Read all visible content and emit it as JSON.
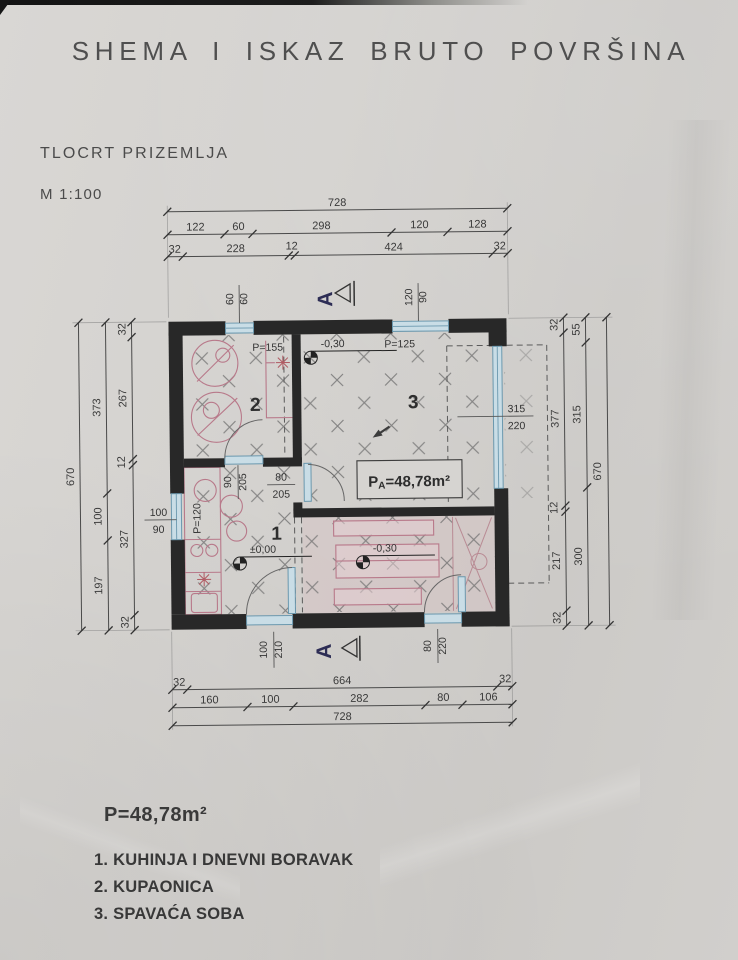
{
  "document": {
    "title": "SHEMA I ISKAZ BRUTO POVRŠINA",
    "drawing_name": "TLOCRT PRIZEMLJA",
    "scale": "M 1:100"
  },
  "summary": {
    "total_area": "P=48,78m²",
    "legend": [
      "1. KUHINJA I DNEVNI BORAVAK",
      "2. KUPAONICA",
      "3. SPAVAĆA SOBA"
    ]
  },
  "plan": {
    "rooms": {
      "kitchen_living": "1",
      "bathroom": "2",
      "bedroom": "3"
    },
    "area_box": {
      "prefix": "P",
      "sub": "A",
      "value": "=48,78m²"
    },
    "levels": {
      "main": "±0,00",
      "bedroom": "-0,30",
      "terrace": "-0,30"
    },
    "parapets": {
      "bathroom_window": "P=155",
      "bedroom_window": "P=125",
      "kitchen_window": "P=120"
    },
    "openings": {
      "bath_window": {
        "w": "60",
        "h": "60"
      },
      "bedroom_window": {
        "w": "120",
        "h": "90"
      },
      "kitchen_window": {
        "w": "100",
        "h": "90"
      },
      "terrace_glass_wall": {
        "w": "315",
        "h": "220"
      },
      "bathroom_door": {
        "w": "90",
        "h": "205"
      },
      "bedroom_door": {
        "w": "80",
        "h": "205"
      },
      "entrance_door": {
        "w": "100",
        "h": "210"
      },
      "terrace_door": {
        "w": "80",
        "h": "220"
      }
    },
    "section_label": "A"
  },
  "dims": {
    "top": {
      "total": "728",
      "row2": [
        "122",
        "60",
        "298",
        "120",
        "128"
      ],
      "row3": [
        "32",
        "228",
        "12",
        "424",
        "32"
      ]
    },
    "bottom": {
      "row1": [
        "32",
        "664",
        "32"
      ],
      "row2": [
        "160",
        "100",
        "282",
        "80",
        "106"
      ],
      "total": "728"
    },
    "left": {
      "total": "670",
      "mid": [
        "373",
        "100",
        "197"
      ],
      "inner": [
        "32",
        "267",
        "12",
        "327",
        "32"
      ]
    },
    "right": {
      "total": "670",
      "mid": [
        "55",
        "315",
        "300"
      ],
      "inner": [
        "32",
        "377",
        "12",
        "217",
        "32"
      ]
    }
  }
}
